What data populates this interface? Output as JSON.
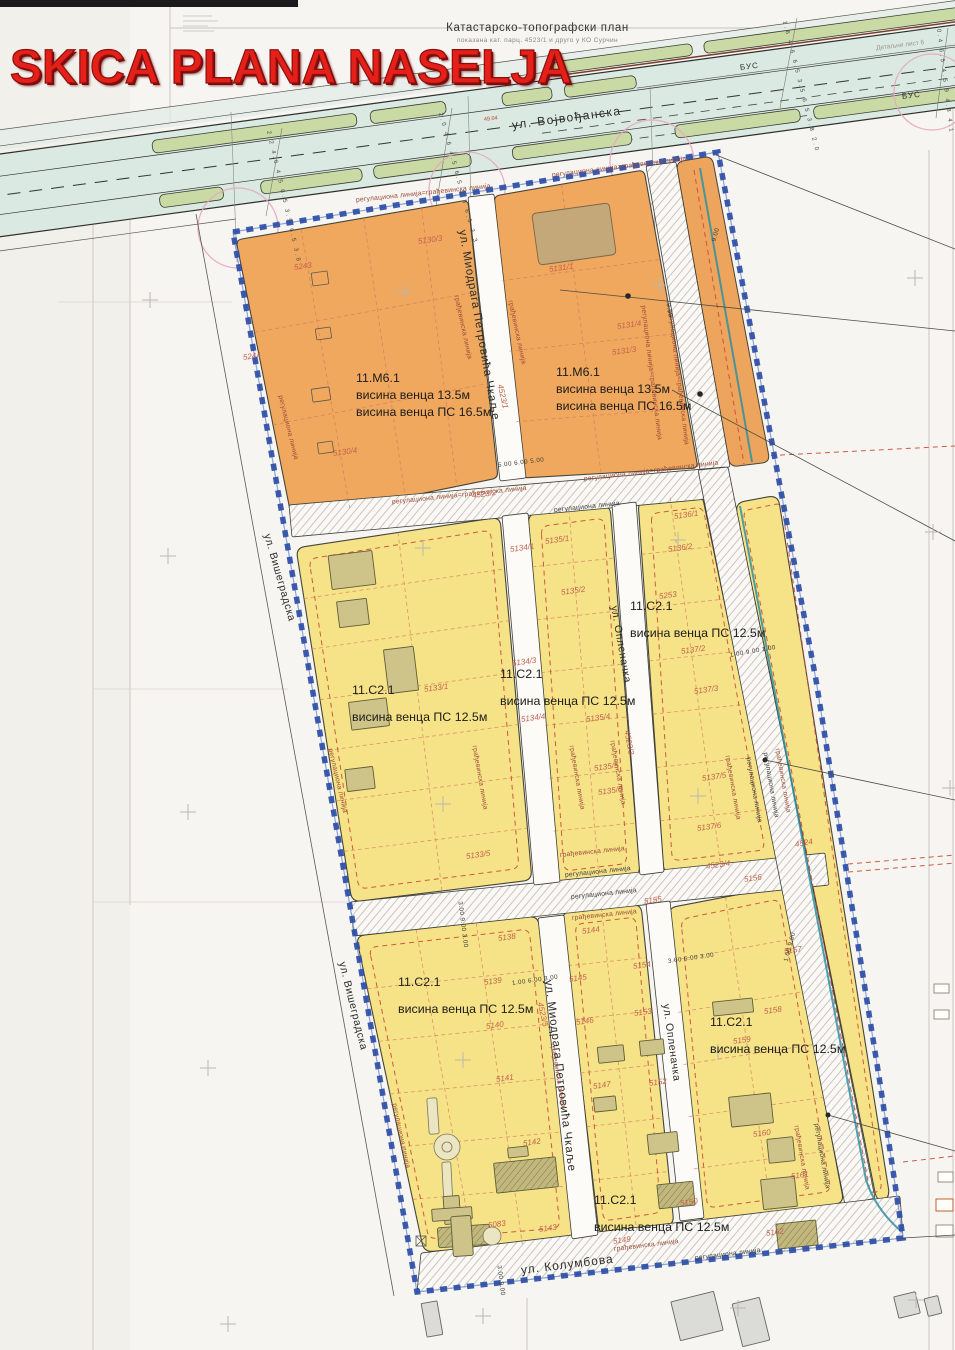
{
  "title": "SKICA PLANA NASELJA",
  "plan_header": {
    "title": "Катастарско-топографски план",
    "subtitle": "показана кат. парц. 4523/1 и друго у КО Сурчин",
    "sheet_note": "Детаљни лист 6"
  },
  "streets": {
    "vojvodjanska": "ул. Војвођанска",
    "miodraga": "ул. Миодрага Петровића Чкаље",
    "visegradska": "ул. Вишеградска",
    "oplenacka": "ул. Опленачка",
    "kolumbova": "ул. Колумбова",
    "bus": "БУС"
  },
  "line_types": {
    "reg": "регулациона линија",
    "grad": "грађевинска линија",
    "reg_grad": "регулациона линија=грађевинска линија"
  },
  "street_labels": [
    {
      "key": "vojvodjanska",
      "x": 512,
      "y": 118,
      "r": -7.5,
      "s": 12,
      "ls": 1.5
    },
    {
      "key": "miodraga",
      "x": 462,
      "y": 224,
      "r": 80,
      "s": 11.5,
      "ls": 0.8
    },
    {
      "key": "miodraga",
      "x": 548,
      "y": 974,
      "r": 83,
      "s": 11.5,
      "ls": 0.8
    },
    {
      "key": "visegradska",
      "x": 267,
      "y": 528,
      "r": 74,
      "s": 10.5,
      "ls": 0.6
    },
    {
      "key": "visegradska",
      "x": 342,
      "y": 956,
      "r": 76,
      "s": 10.5,
      "ls": 0.6
    },
    {
      "key": "oplenacka",
      "x": 614,
      "y": 600,
      "r": 80,
      "s": 10.5,
      "ls": 0.6
    },
    {
      "key": "oplenacka",
      "x": 666,
      "y": 998,
      "r": 82,
      "s": 10.5,
      "ls": 0.6
    },
    {
      "key": "kolumbova",
      "x": 521,
      "y": 1263,
      "r": -7,
      "s": 12,
      "ls": 1
    },
    {
      "key": "bus",
      "x": 740,
      "y": 63,
      "r": -7,
      "s": 8,
      "ls": 1
    },
    {
      "key": "bus",
      "x": 902,
      "y": 92,
      "r": -7,
      "s": 8,
      "ls": 1
    }
  ],
  "zones": [
    {
      "code": "11.М6.1",
      "lines": [
        "висина венца 13.5м",
        "висина венца ПС 16.5м"
      ],
      "x": 356,
      "y": 370
    },
    {
      "code": "11.М6.1",
      "lines": [
        "висина венца 13.5м",
        "висина венца ПС 16.5м"
      ],
      "x": 556,
      "y": 364
    },
    {
      "code": "11.С2.1",
      "lines": [
        "висина венца ПС 12.5м"
      ],
      "x": 352,
      "y": 682
    },
    {
      "code": "11.С2.1",
      "lines": [
        "висина венца ПС 12.5м"
      ],
      "x": 500,
      "y": 666
    },
    {
      "code": "11.С2.1",
      "lines": [
        "висина венца ПС 12.5м"
      ],
      "x": 630,
      "y": 598
    },
    {
      "code": "11.С2.1",
      "lines": [
        "висина венца ПС 12.5м"
      ],
      "x": 398,
      "y": 974
    },
    {
      "code": "11.С2.1",
      "lines": [
        "висина венца ПС 12.5м"
      ],
      "x": 594,
      "y": 1192
    },
    {
      "code": "11.С2.1",
      "lines": [
        "висина венца ПС 12.5м"
      ],
      "x": 710,
      "y": 1014
    }
  ],
  "parcels": [
    {
      "t": "5243",
      "x": 294,
      "y": 263
    },
    {
      "t": "5244",
      "x": 243,
      "y": 353
    },
    {
      "t": "5130/3",
      "x": 418,
      "y": 237
    },
    {
      "t": "5130/4",
      "x": 333,
      "y": 449
    },
    {
      "t": "5131/1",
      "x": 549,
      "y": 265
    },
    {
      "t": "5131/4",
      "x": 617,
      "y": 322
    },
    {
      "t": "5131/3",
      "x": 612,
      "y": 348
    },
    {
      "t": "4523/1",
      "x": 500,
      "y": 380,
      "r": 77
    },
    {
      "t": "4523/2",
      "x": 472,
      "y": 491,
      "r": -7
    },
    {
      "t": "4523/3",
      "x": 627,
      "y": 726,
      "r": 80
    },
    {
      "t": "4523/4",
      "x": 706,
      "y": 862,
      "r": -8
    },
    {
      "t": "4523/5",
      "x": 540,
      "y": 998,
      "r": 77
    },
    {
      "t": "4524",
      "x": 795,
      "y": 840,
      "r": -10
    },
    {
      "t": "5136/1",
      "x": 674,
      "y": 512
    },
    {
      "t": "5136/2",
      "x": 668,
      "y": 545
    },
    {
      "t": "5135/1",
      "x": 545,
      "y": 537
    },
    {
      "t": "5134/1",
      "x": 510,
      "y": 545
    },
    {
      "t": "5135/2",
      "x": 561,
      "y": 588
    },
    {
      "t": "5253",
      "x": 659,
      "y": 592
    },
    {
      "t": "5137/2",
      "x": 681,
      "y": 647
    },
    {
      "t": "5134/3",
      "x": 512,
      "y": 659
    },
    {
      "t": "5134/4",
      "x": 521,
      "y": 715
    },
    {
      "t": "5135/4",
      "x": 586,
      "y": 715
    },
    {
      "t": "5133/1",
      "x": 424,
      "y": 685
    },
    {
      "t": "5135/5",
      "x": 594,
      "y": 764
    },
    {
      "t": "5135/6",
      "x": 598,
      "y": 788
    },
    {
      "t": "5137/3",
      "x": 694,
      "y": 687
    },
    {
      "t": "5137/5",
      "x": 702,
      "y": 774
    },
    {
      "t": "5137/6",
      "x": 697,
      "y": 824
    },
    {
      "t": "5133/5",
      "x": 466,
      "y": 852
    },
    {
      "t": "5155",
      "x": 644,
      "y": 897
    },
    {
      "t": "5156",
      "x": 744,
      "y": 875
    },
    {
      "t": "5157",
      "x": 784,
      "y": 947
    },
    {
      "t": "5138",
      "x": 498,
      "y": 934
    },
    {
      "t": "5139",
      "x": 484,
      "y": 978
    },
    {
      "t": "5144",
      "x": 582,
      "y": 927
    },
    {
      "t": "5145",
      "x": 569,
      "y": 975
    },
    {
      "t": "5154",
      "x": 633,
      "y": 962
    },
    {
      "t": "5140",
      "x": 486,
      "y": 1022
    },
    {
      "t": "5146",
      "x": 576,
      "y": 1018
    },
    {
      "t": "5153",
      "x": 634,
      "y": 1009
    },
    {
      "t": "5141",
      "x": 496,
      "y": 1075
    },
    {
      "t": "5147",
      "x": 593,
      "y": 1082
    },
    {
      "t": "5152",
      "x": 649,
      "y": 1079
    },
    {
      "t": "5158",
      "x": 764,
      "y": 1007
    },
    {
      "t": "5159",
      "x": 733,
      "y": 1037
    },
    {
      "t": "5142",
      "x": 523,
      "y": 1139
    },
    {
      "t": "5160",
      "x": 753,
      "y": 1130
    },
    {
      "t": "5161",
      "x": 791,
      "y": 1172
    },
    {
      "t": "5150",
      "x": 680,
      "y": 1199
    },
    {
      "t": "5149",
      "x": 613,
      "y": 1237
    },
    {
      "t": "5143",
      "x": 539,
      "y": 1225
    },
    {
      "t": "5083",
      "x": 488,
      "y": 1221
    },
    {
      "t": "5162",
      "x": 766,
      "y": 1229
    }
  ],
  "dims": [
    {
      "t": "9.00",
      "x": 714,
      "y": 238,
      "r": -75
    },
    {
      "t": "9.00",
      "x": 668,
      "y": 300,
      "r": 80
    },
    {
      "t": "5.00 6.00 5.00",
      "x": 498,
      "y": 462,
      "r": -7
    },
    {
      "t": "1.00 9.00 1.00",
      "x": 730,
      "y": 652,
      "r": -10
    },
    {
      "t": "3.00 9.00 3.00",
      "x": 460,
      "y": 898,
      "r": 83
    },
    {
      "t": "1.00 6.00 3.00",
      "x": 512,
      "y": 980,
      "r": -8
    },
    {
      "t": "3.00 6.00 3.00",
      "x": 668,
      "y": 958,
      "r": -8
    },
    {
      "t": "1.00 9.00",
      "x": 786,
      "y": 958,
      "r": -75
    },
    {
      "t": "3.00 9.00",
      "x": 499,
      "y": 1262,
      "r": 83
    },
    {
      "t": "2.2 4.6 4.5 6.5 3.5 6.5 3.8",
      "x": 268,
      "y": 128,
      "r": 77,
      "c": "chain"
    },
    {
      "t": "2.0 4.6 4.5 6.5 3.5 6.5 3.3",
      "x": 440,
      "y": 110,
      "r": 75,
      "c": "chain"
    },
    {
      "t": "1.6 4.6 6.5 3.5 6.5 3.8 2.0",
      "x": 784,
      "y": 18,
      "r": 76,
      "c": "chain"
    },
    {
      "t": "0.4 6.5 4.5 9 4.8 4.1",
      "x": 938,
      "y": 26,
      "r": 83,
      "c": "chain"
    }
  ],
  "marks": [
    {
      "t": "49.04",
      "x": 484,
      "y": 117,
      "r": -7
    }
  ],
  "line_instances": [
    {
      "k": "reg_grad",
      "x": 356,
      "y": 197,
      "r": -6,
      "c": "r"
    },
    {
      "k": "reg_grad",
      "x": 552,
      "y": 172,
      "r": -7,
      "c": "r"
    },
    {
      "k": "reg_grad",
      "x": 643,
      "y": 302,
      "r": 83,
      "c": "r"
    },
    {
      "k": "reg_grad",
      "x": 670,
      "y": 307,
      "r": 83,
      "c": "r"
    },
    {
      "k": "reg_grad",
      "x": 392,
      "y": 499,
      "r": -6,
      "c": "r"
    },
    {
      "k": "reg_grad",
      "x": 584,
      "y": 476,
      "r": -7,
      "c": "r"
    },
    {
      "k": "reg",
      "x": 554,
      "y": 507,
      "r": -6,
      "c": "k"
    },
    {
      "k": "reg",
      "x": 565,
      "y": 872,
      "r": -6,
      "c": "k"
    },
    {
      "k": "reg",
      "x": 571,
      "y": 894,
      "r": -6,
      "c": "k"
    },
    {
      "k": "reg",
      "x": 748,
      "y": 754,
      "r": 80,
      "c": "k"
    },
    {
      "k": "reg",
      "x": 765,
      "y": 749,
      "r": 80,
      "c": "k"
    },
    {
      "k": "reg",
      "x": 695,
      "y": 1255,
      "r": -7,
      "c": "k"
    },
    {
      "k": "reg",
      "x": 816,
      "y": 1120,
      "r": 80,
      "c": "k"
    },
    {
      "k": "reg",
      "x": 280,
      "y": 392,
      "r": 76,
      "c": "r"
    },
    {
      "k": "reg",
      "x": 330,
      "y": 745,
      "r": 77,
      "c": "r"
    },
    {
      "k": "reg",
      "x": 394,
      "y": 1100,
      "r": 78,
      "c": "r"
    },
    {
      "k": "grad",
      "x": 456,
      "y": 292,
      "r": 78,
      "c": "r"
    },
    {
      "k": "grad",
      "x": 510,
      "y": 297,
      "r": 78,
      "c": "r"
    },
    {
      "k": "grad",
      "x": 560,
      "y": 852,
      "r": -6,
      "c": "r"
    },
    {
      "k": "grad",
      "x": 572,
      "y": 915,
      "r": -6,
      "c": "r"
    },
    {
      "k": "grad",
      "x": 727,
      "y": 752,
      "r": 80,
      "c": "r"
    },
    {
      "k": "grad",
      "x": 777,
      "y": 745,
      "r": 80,
      "c": "r"
    },
    {
      "k": "grad",
      "x": 614,
      "y": 1246,
      "r": -7,
      "c": "r"
    },
    {
      "k": "grad",
      "x": 474,
      "y": 742,
      "r": 80,
      "c": "r"
    },
    {
      "k": "grad",
      "x": 571,
      "y": 742,
      "r": 80,
      "c": "r"
    },
    {
      "k": "grad",
      "x": 612,
      "y": 737,
      "r": 80,
      "c": "r"
    },
    {
      "k": "grad",
      "x": 552,
      "y": 1040,
      "r": 80,
      "c": "r"
    },
    {
      "k": "grad",
      "x": 796,
      "y": 1122,
      "r": 80,
      "c": "r"
    }
  ]
}
